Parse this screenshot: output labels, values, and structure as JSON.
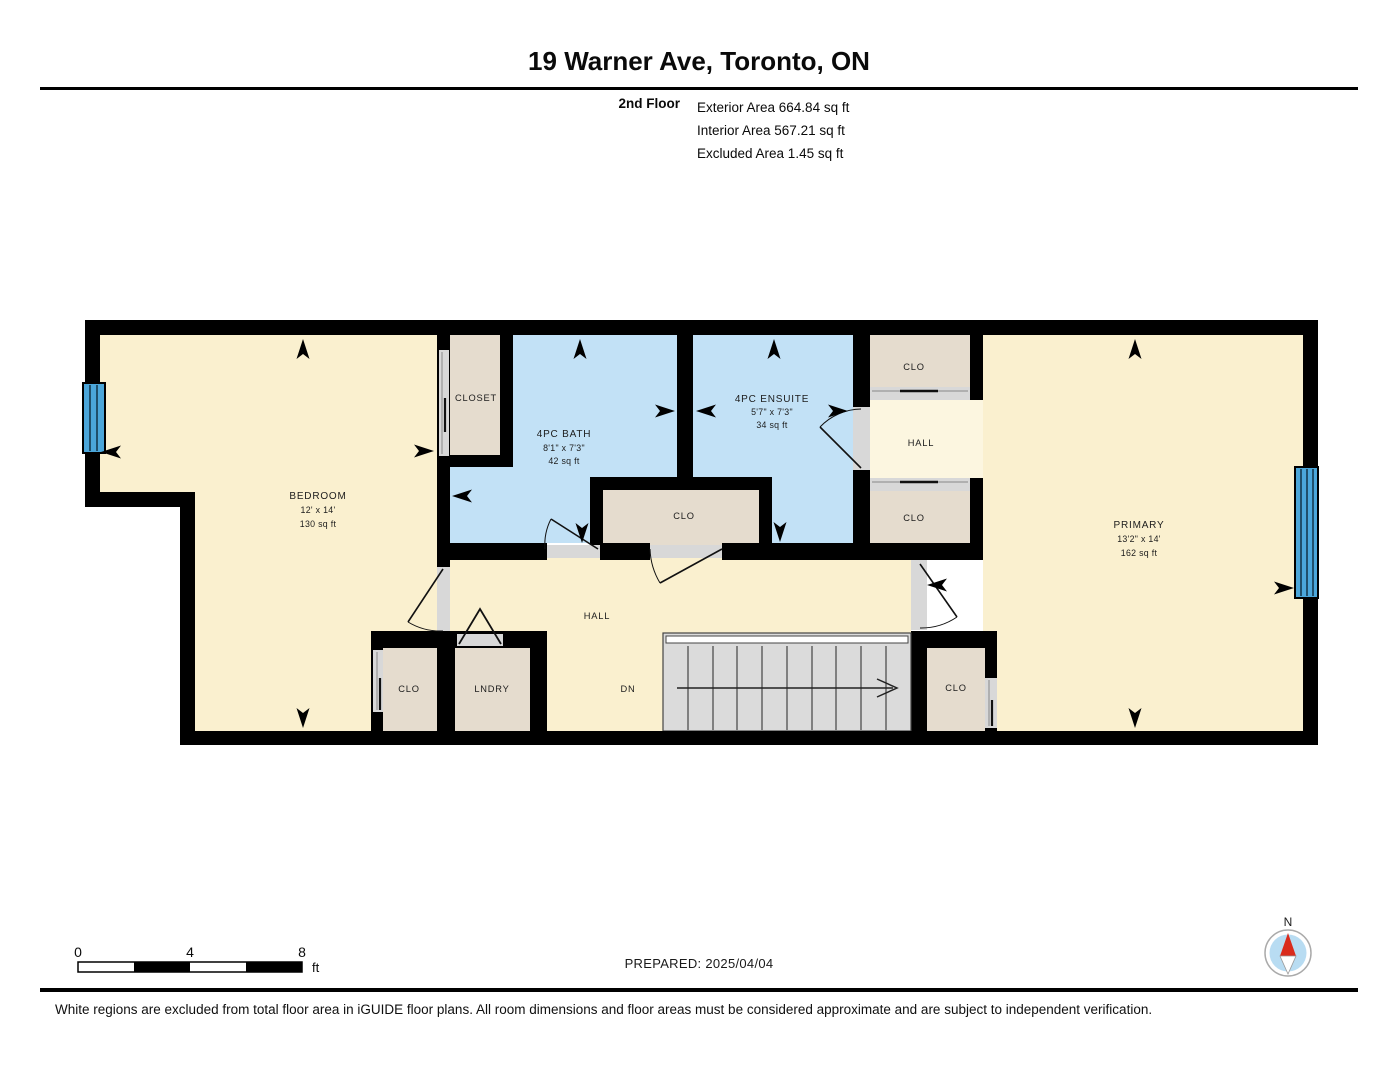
{
  "header": {
    "title": "19 Warner Ave, Toronto, ON",
    "floor_label": "2nd Floor",
    "areas": {
      "exterior": "Exterior Area 664.84 sq ft",
      "interior": "Interior Area 567.21 sq ft",
      "excluded": "Excluded Area 1.45 sq ft"
    }
  },
  "floorplan": {
    "rooms": {
      "bedroom": {
        "name": "BEDROOM",
        "dims": "12' x 14'",
        "area": "130 sq ft"
      },
      "closet": {
        "name": "CLOSET"
      },
      "bath": {
        "name": "4PC BATH",
        "dims": "8'1\" x 7'3\"",
        "area": "42 sq ft"
      },
      "ensuite": {
        "name": "4PC ENSUITE",
        "dims": "5'7\" x 7'3\"",
        "area": "34 sq ft"
      },
      "clo_upper_top": {
        "name": "CLO"
      },
      "hall_upper": {
        "name": "HALL"
      },
      "clo_upper_bottom": {
        "name": "CLO"
      },
      "clo_middle": {
        "name": "CLO"
      },
      "primary": {
        "name": "PRIMARY",
        "dims": "13'2\" x 14'",
        "area": "162 sq ft"
      },
      "hall_main": {
        "name": "HALL"
      },
      "clo_bedroom": {
        "name": "CLO"
      },
      "laundry": {
        "name": "LNDRY"
      },
      "clo_primary": {
        "name": "CLO"
      },
      "stairs": {
        "label": "DN"
      }
    }
  },
  "footer": {
    "scale_bar": {
      "tick_0": "0",
      "tick_4": "4",
      "tick_8": "8",
      "unit": "ft"
    },
    "prepared": "PREPARED: 2025/04/04",
    "compass": {
      "north_label": "N"
    },
    "disclaimer": "White regions are excluded from total floor area in iGUIDE floor plans. All room dimensions and floor areas must be considered approximate and are subject to independent verification."
  },
  "colors": {
    "room_fill": "#FAF0CF",
    "hall_upper_fill": "#FCF6E0",
    "wet_room_fill": "#C2E1F6",
    "closet_fill": "#E5DCCE",
    "stairs_fill": "#DBDBDB",
    "window_fill": "#4BA6DA",
    "wall": "#000000",
    "compass_north": "#D92B1C"
  }
}
